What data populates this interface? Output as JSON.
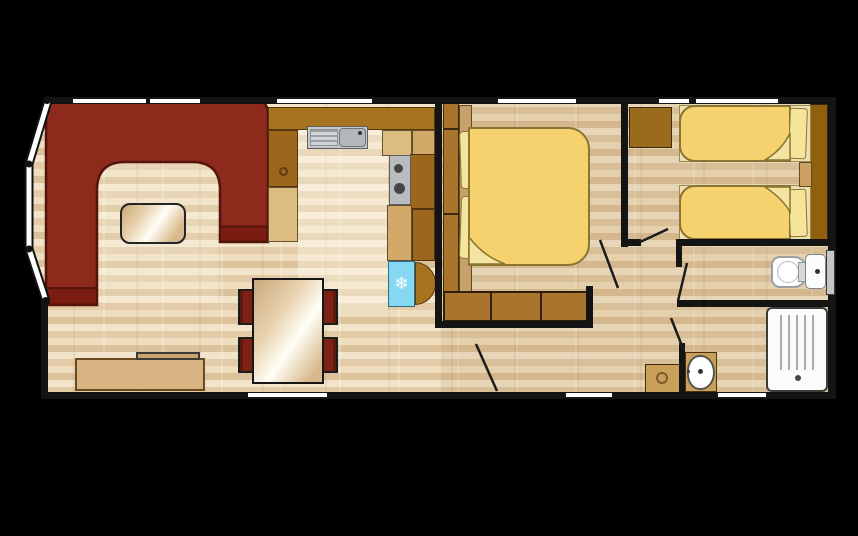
{
  "meta": {
    "title": "Static holiday home floor plan, top-down 2D view",
    "canvas": {
      "width": 858,
      "height": 536
    },
    "background": "#000000"
  },
  "icons": {
    "snowflake": "❄"
  },
  "palette": {
    "walls": "#141414",
    "floor_light": "#f2e4cb",
    "floor_dark": "#dcc29a",
    "sofa_red": "#8d2a1c",
    "sofa_red_dark": "#7a1d10",
    "chair_red": "#7d2114",
    "worktop_brown": "#a6731e",
    "cabinet_dark_brown": "#9c671c",
    "cabinet_light_tan": "#dcbc80",
    "wardrobe_brown": "#a9752c",
    "headboard_brown": "#91600f",
    "bedding_gold": "#f6d26e",
    "pillow_cream": "#f5e49a",
    "fridge_blue": "#86d7f2",
    "appliance_grey": "#c6c9cb",
    "fixture_white": "#ffffff",
    "window_white": "#ffffff",
    "frosted_window_grey": "#c6c6c6"
  },
  "rooms": [
    {
      "id": "lounge",
      "features": [
        "corner-sofa",
        "coffee-table",
        "tv-unit",
        "tv",
        "dining-table",
        "dining-chairs-x4",
        "bay-windows"
      ]
    },
    {
      "id": "kitchen",
      "features": [
        "worktop",
        "sink-with-drainer",
        "hob",
        "fridge",
        "cabinets"
      ]
    },
    {
      "id": "entrance-hall",
      "features": [
        "entrance-door"
      ]
    },
    {
      "id": "double-bedroom",
      "features": [
        "double-bed",
        "two-pillows",
        "wardrobe",
        "foot-of-bed-drawers",
        "window"
      ]
    },
    {
      "id": "twin-bedroom",
      "features": [
        "single-bed-x2",
        "pillows",
        "bedside-shelf",
        "storage-cabinet",
        "headboard-panel"
      ]
    },
    {
      "id": "wc",
      "features": [
        "toilet",
        "frosted-window"
      ]
    },
    {
      "id": "shower-room",
      "features": [
        "shower-tray",
        "washbasin"
      ]
    },
    {
      "id": "hallway",
      "features": [
        "storage-cabinet",
        "door-swings"
      ]
    }
  ],
  "counts": {
    "windows": 13,
    "door_leaves": 5,
    "beds": 3,
    "dining_chairs": 4
  }
}
